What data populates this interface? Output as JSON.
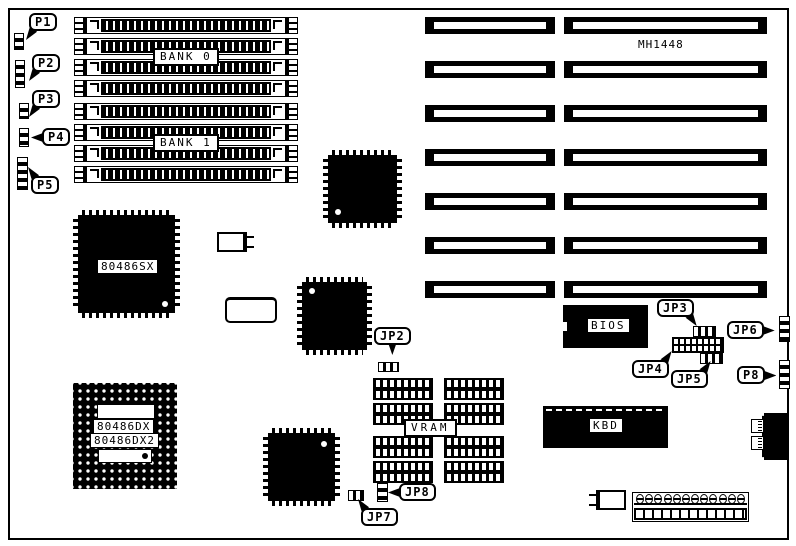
{
  "board": {
    "model": "MH1448",
    "memory": {
      "bank0": "BANK 0",
      "bank1": "BANK 1"
    },
    "chips": {
      "cpu_sx": "80486SX",
      "cpu_dx": "80486DX",
      "cpu_dx2": "80486DX2",
      "bios": "BIOS",
      "kbd": "KBD",
      "vram": "VRAM"
    },
    "callouts": {
      "p1": "P1",
      "p2": "P2",
      "p3": "P3",
      "p4": "P4",
      "p5": "P5",
      "p8": "P8",
      "jp2": "JP2",
      "jp3": "JP3",
      "jp4": "JP4",
      "jp5": "JP5",
      "jp6": "JP6",
      "jp7": "JP7",
      "jp8": "JP8"
    },
    "colors": {
      "ink": "#000000",
      "paper": "#ffffff"
    }
  }
}
